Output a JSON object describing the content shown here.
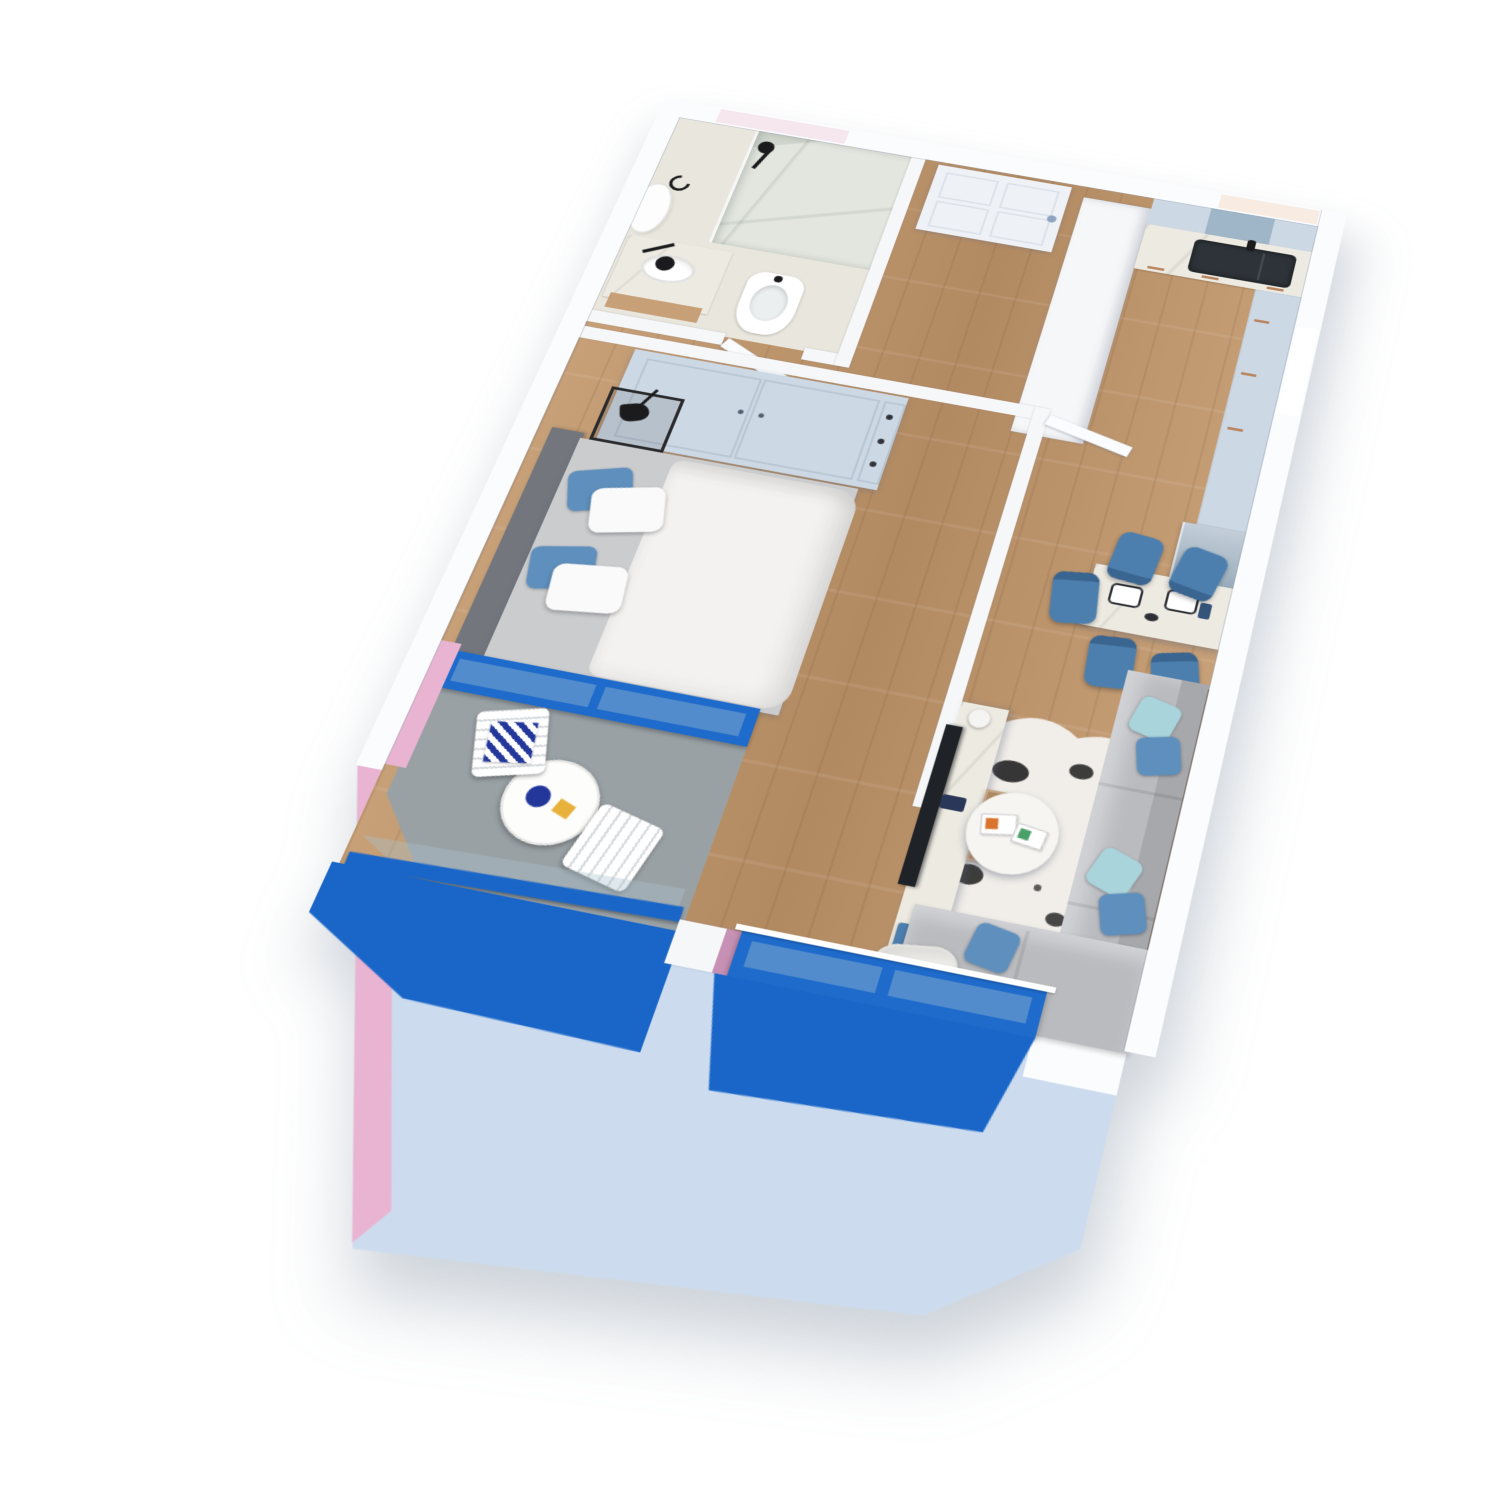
{
  "meta": {
    "kind": "3d-cutaway-apartment-floor-plan",
    "style": "photoreal render, top-down tilted view, no text labels"
  },
  "palette": {
    "page": "#ffffff",
    "wall": "#f6f7f9",
    "cut": "#fbfcfe",
    "facade": "#ccdcee",
    "blue": "#1a66c8",
    "frame": "#1e6bcb",
    "pink": "#e9b4d1",
    "mauve": "#c791b5",
    "wood1": "#c7a078",
    "wood2": "#b28a62",
    "grayfloor": "#99a1a5",
    "marble": "#edeae2",
    "shower_marble": "#e2e6de",
    "bath_floor": "#e9e6dd",
    "cabinet": "#ccd8e4",
    "cabinet_glass": "#9fb6c8",
    "copper": "#b9855f",
    "fridge_top": "#c3ced8",
    "fridge_bot": "#8098ab",
    "sink_dark": "#2d3338",
    "sofa": "#b9bbbf",
    "sofa_dark": "#a6a8ac",
    "headboard": "#73767c",
    "duvet": "#f3f2f0",
    "mattress": "#cbccce",
    "chair_blue": "#4d7fae",
    "pillow_blue": "#5e8fbd",
    "pillow_teal": "#a9d4dc",
    "navy": "#23379b",
    "black": "#1b1b1d",
    "tv": "#1f2327",
    "white": "#ffffff",
    "rug": "#f2f1ee",
    "orange": "#d9732e",
    "toast": "#e8b13c",
    "window_pink": "#f6e6ee",
    "window_peach": "#f8ece2"
  },
  "scene": {
    "rooms": [
      {
        "name": "bathroom",
        "items": [
          "marble-walk-in-shower",
          "black-shower-fixture",
          "vanity-sink",
          "wood-vanity-base",
          "round-mirror",
          "bidet",
          "swing-door"
        ]
      },
      {
        "name": "entry-hall",
        "items": [
          "front-door",
          "tall-white-cabinet",
          "wood-floor"
        ]
      },
      {
        "name": "kitchen",
        "items": [
          "upper-cabinets",
          "glass-upper-cabinet",
          "marble-counter",
          "dark-double-sink",
          "black-tap",
          "base-cabinets-copper-handles",
          "tall-fridge-unit"
        ]
      },
      {
        "name": "bedroom",
        "items": [
          "wardrobe-two-doors-drawers",
          "double-bed",
          "gray-headboard",
          "blue-pillows",
          "white-pillows",
          "white-duvet",
          "black-frame-nightstand",
          "black-cone-lamp",
          "glass-side-table",
          "swing-door"
        ]
      },
      {
        "name": "dining-area",
        "items": [
          "marble-dining-table",
          "blue-chairs-x5",
          "place-settings"
        ]
      },
      {
        "name": "living-room",
        "items": [
          "marble-tv-sideboard",
          "flat-tv",
          "table-lamp",
          "blue-vase-box",
          "wood-drawer-unit",
          "cowhide-rug",
          "round-coffee-table",
          "magazines",
          "sectional-sofa",
          "blue-and-teal-pillows",
          "white-quilted-armchair",
          "orange-stool"
        ]
      },
      {
        "name": "bedroom-balcony",
        "items": [
          "gray-floor",
          "white-bistro-table",
          "breakfast-set",
          "white-folding-chairs-x2",
          "navy-zigzag-cushion",
          "blue-glass-railing",
          "pink-accent-wall",
          "blue-floor-slab"
        ]
      },
      {
        "name": "living-window",
        "items": [
          "blue-french-window",
          "white-top-rail",
          "mauve-reveal",
          "blue-sill-slab"
        ]
      },
      {
        "name": "facade",
        "items": [
          "light-blue-south-apron",
          "white-north-band",
          "pale-pink-window",
          "pale-peach-window",
          "chamfered-corner"
        ]
      }
    ],
    "accent_summary": {
      "primary_accent": "vivid blue",
      "secondary_accent": "pink",
      "furniture_accent": "steel blue",
      "facade": "pale blue"
    }
  }
}
